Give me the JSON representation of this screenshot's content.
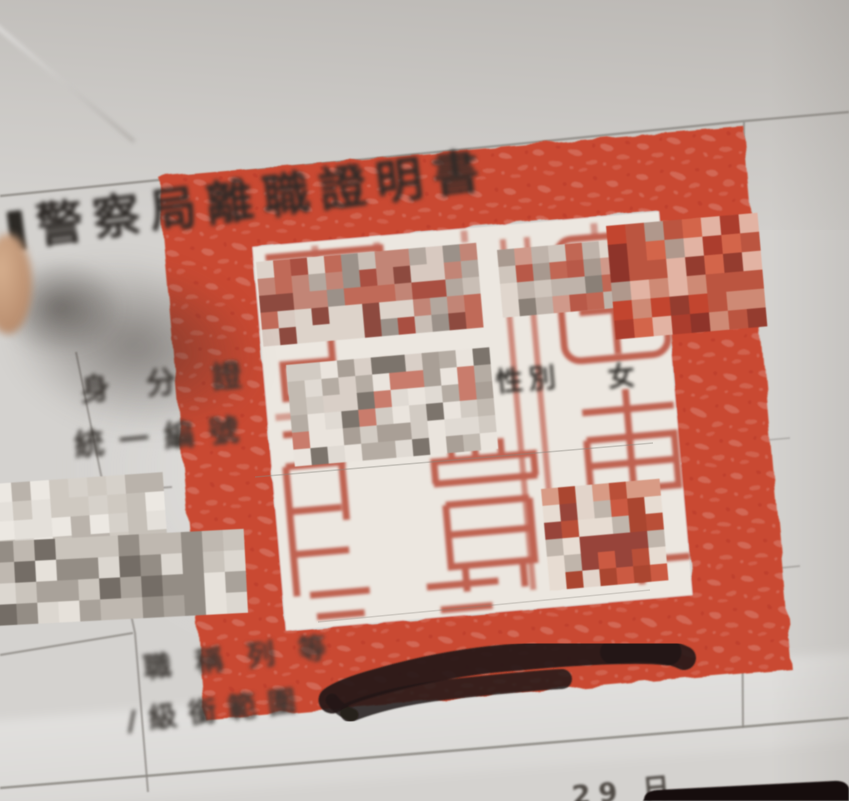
{
  "document": {
    "title": "警察局離職證明書",
    "id_field": {
      "line1": "身分證",
      "line2": "統一編號"
    },
    "gender_field": {
      "label": "性別",
      "value": "女"
    },
    "rank_field": {
      "line1": "職稱列等",
      "line2": "/級銜範圍"
    },
    "date_fragment": "29 日"
  },
  "stamp": {
    "shape": "square",
    "ink_color": "#c94a33"
  },
  "colors": {
    "background_paper": "#d4d2cf",
    "certificate_paper": "#ece7e0",
    "seal_red": "#c94a33",
    "grid_line": "#8c8883",
    "text_black": "#2e2a27",
    "marker_black": "#221a16",
    "corner_object_black": "#131110",
    "finger_skin": "#c6a081"
  },
  "redaction_patches": [
    {
      "name": "seal-top-left",
      "x": 256,
      "y": 262,
      "w": 210,
      "h": 74,
      "cell": 17,
      "rot": -5,
      "seed": 3,
      "palette": [
        "#c9beb5",
        "#b3a79e",
        "#c06a58",
        "#a94f41",
        "#ddd3ca",
        "#c28576",
        "#9b9189",
        "#d8c9c0",
        "#8d4a3f"
      ]
    },
    {
      "name": "seal-top-right",
      "x": 497,
      "y": 250,
      "w": 170,
      "h": 68,
      "cell": 17,
      "rot": -5,
      "seed": 7,
      "palette": [
        "#cfc5bc",
        "#bfb3aa",
        "#c16754",
        "#d0998a",
        "#e0d6cd",
        "#a8998f",
        "#b85948",
        "#8a8077"
      ]
    },
    {
      "name": "seal-band-right",
      "x": 606,
      "y": 226,
      "w": 145,
      "h": 102,
      "cell": 19,
      "rot": -5,
      "seed": 11,
      "palette": [
        "#c2452f",
        "#ab3d2d",
        "#d3654a",
        "#943c2f",
        "#ce8a75",
        "#bb5540",
        "#e2b3a3",
        "#8e342a",
        "#b0988c"
      ]
    },
    {
      "name": "id-number",
      "x": 286,
      "y": 365,
      "w": 188,
      "h": 90,
      "cell": 17,
      "rot": -5,
      "seed": 13,
      "palette": [
        "#e0dad3",
        "#d2cbc3",
        "#c2bab1",
        "#eae4dd",
        "#b5aca3",
        "#c97c6c",
        "#d9cfc7",
        "#a99f96",
        "#7c746c"
      ]
    },
    {
      "name": "seal-bottom-right",
      "x": 541,
      "y": 489,
      "w": 106,
      "h": 100,
      "cell": 17,
      "rot": -5,
      "seed": 17,
      "palette": [
        "#cb5a42",
        "#e2d4ca",
        "#aa4630",
        "#d89b85",
        "#c0b5ab",
        "#b94f38",
        "#e7dcd2",
        "#97443a"
      ]
    },
    {
      "name": "left-margin-upper",
      "x": -8,
      "y": 484,
      "w": 154,
      "h": 60,
      "cell": 19,
      "rot": -4,
      "seed": 19,
      "palette": [
        "#e4e0da",
        "#d6d1ca",
        "#c6c0b8",
        "#ece8e2",
        "#cfc9c1",
        "#bab3ab"
      ]
    },
    {
      "name": "left-margin-lower",
      "x": -8,
      "y": 542,
      "w": 240,
      "h": 64,
      "cell": 21,
      "rot": -3,
      "seed": 23,
      "palette": [
        "#dcd7d0",
        "#cac4bc",
        "#a9a29a",
        "#746d66",
        "#e6e1da",
        "#948d85",
        "#bfb8b0"
      ]
    }
  ]
}
